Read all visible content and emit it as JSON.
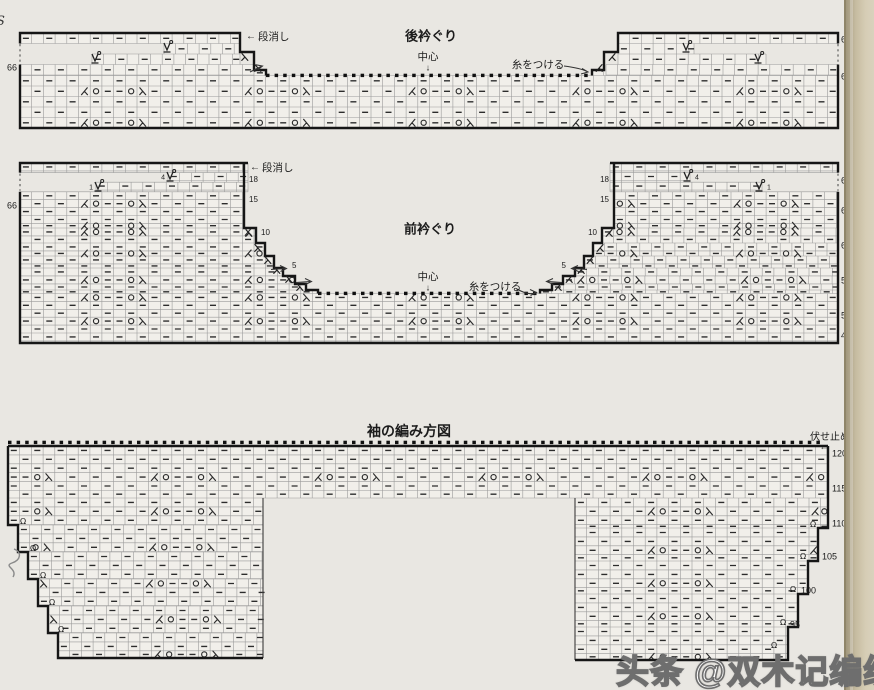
{
  "page": {
    "width": 874,
    "height": 690,
    "background": "#e9e7e2",
    "edge_strip_colors": [
      "#a1977d",
      "#c6bca1",
      "#d9d2bd"
    ]
  },
  "edge_fragment": "S",
  "watermark": {
    "text": "头条 @双木记编织"
  },
  "motif_sequence": [
    "ssk",
    "yo",
    "dash",
    "dash",
    "yo",
    "k2tog"
  ],
  "charts": [
    {
      "id": "back-neckline",
      "grid": {
        "cw": 11.7,
        "ch": 10.5,
        "x0": 20,
        "y0": 33,
        "m0": 5,
        "rm0": 2,
        "rp": 3,
        "rmin": 4
      },
      "bands": [
        [
          20,
          33,
          240,
          43.5
        ],
        [
          164,
          43.5,
          240,
          54
        ],
        [
          92,
          54,
          240,
          64.5
        ],
        [
          20,
          64.5,
          254,
          75.5
        ],
        [
          254,
          70,
          266,
          75.5
        ],
        [
          618,
          33,
          838,
          43.5
        ],
        [
          618,
          43.5,
          694,
          54
        ],
        [
          618,
          54,
          766,
          64.5
        ],
        [
          606,
          64.5,
          838,
          75.5
        ],
        [
          592,
          70,
          606,
          75.5
        ],
        [
          20,
          75.5,
          838,
          128
        ]
      ],
      "outlines": [
        "M20,43.5 V33 H240 V52 H254 V70 H266 V75.5",
        "M838,43.5 V33 H618 V52 H604 V70 H592 V75.5",
        "M20,64.5 V128 H838 V64.5"
      ],
      "thin": [],
      "dotted_v": [
        [
          20,
          44,
          20,
          63
        ],
        [
          838,
          44,
          838,
          63
        ]
      ],
      "dots": [
        [
          266,
          592,
          75.5
        ]
      ],
      "marks": [
        {
          "g": "wrap",
          "x": 167,
          "y": 47
        },
        {
          "g": "wrap",
          "x": 95,
          "y": 58
        },
        {
          "g": "wrap",
          "x": 686,
          "y": 47
        },
        {
          "g": "wrap",
          "x": 758,
          "y": 58
        },
        {
          "g": "k2tog",
          "x": 245,
          "y": 57
        },
        {
          "g": "k2tog",
          "x": 258,
          "y": 68
        },
        {
          "g": "ssk",
          "x": 612,
          "y": 57
        },
        {
          "g": "ssk",
          "x": 599,
          "y": 68
        }
      ],
      "leaders": [
        {
          "d": "M564,66 Q580,68 587,71.5 M582,68.5 L588,72 L581,74"
        },
        {
          "d": "M250,72 L261,66.5 M256,64.8 L262.5,66 L257.5,70"
        }
      ],
      "labels": [
        {
          "n": "chart1-title",
          "t": "後衿ぐり",
          "x": 431,
          "y": 36,
          "fs": 13,
          "b": 1,
          "a": "c"
        },
        {
          "n": "chart1-dankeshi-arrow",
          "t": "←",
          "x": 246,
          "y": 37,
          "fs": 10,
          "a": "l"
        },
        {
          "n": "chart1-dankeshi",
          "t": "段消し",
          "x": 258,
          "y": 37,
          "fs": 10.5,
          "a": "l"
        },
        {
          "n": "chart1-center",
          "t": "中心",
          "x": 428,
          "y": 57,
          "fs": 10.5,
          "a": "c"
        },
        {
          "n": "chart1-center-arrow",
          "t": "↓",
          "x": 428,
          "y": 68,
          "fs": 9,
          "a": "c"
        },
        {
          "n": "chart1-attach-yarn",
          "t": "糸をつける",
          "x": 538,
          "y": 65,
          "fs": 10.5,
          "a": "c"
        },
        {
          "n": "chart1-row-66-left",
          "t": "66",
          "x": 17,
          "y": 68,
          "fs": 9,
          "a": "r"
        },
        {
          "n": "chart1-row-66-right",
          "t": "66",
          "x": 841,
          "y": 40,
          "fs": 9,
          "a": "l"
        },
        {
          "n": "chart1-row-65-right",
          "t": "65",
          "x": 841,
          "y": 77,
          "fs": 9,
          "a": "l"
        }
      ]
    },
    {
      "id": "front-neckline",
      "grid": {
        "cw": 11.7,
        "ch": 7.9,
        "x0": 20,
        "y0": 163,
        "m0": 5,
        "rm0": 2,
        "rp": 3,
        "rmin": 5
      },
      "bands": [
        [
          20,
          163,
          248,
          172.6
        ],
        [
          168,
          172.6,
          248,
          182.2
        ],
        [
          96,
          182.2,
          248,
          191.8
        ],
        [
          20,
          191.8,
          244,
          228
        ],
        [
          20,
          228,
          256,
          243
        ],
        [
          20,
          243,
          265,
          256
        ],
        [
          20,
          256,
          274,
          268
        ],
        [
          20,
          268,
          283,
          276
        ],
        [
          20,
          276,
          295,
          284
        ],
        [
          20,
          284,
          306,
          290
        ],
        [
          20,
          290,
          318,
          293.5
        ],
        [
          610,
          163,
          838,
          172.6
        ],
        [
          610,
          172.6,
          690,
          182.2
        ],
        [
          610,
          182.2,
          762,
          191.8
        ],
        [
          614,
          191.8,
          838,
          228
        ],
        [
          602,
          228,
          838,
          243
        ],
        [
          593,
          243,
          838,
          256
        ],
        [
          584,
          256,
          838,
          268
        ],
        [
          575,
          268,
          838,
          276
        ],
        [
          563,
          276,
          838,
          284
        ],
        [
          552,
          284,
          838,
          290
        ],
        [
          540,
          290,
          838,
          293.5
        ],
        [
          20,
          293.5,
          838,
          343
        ]
      ],
      "outlines": [
        "M20,172.6 V163 H248 M244,163 V228 H256 V243 H265 V256 H274 V268 H283 V276 H295 V284 H306 V290 H318 V293.5",
        "M838,172.6 V163 H610 M614,163 V228 H602 V243 H593 V256 H584 V268 H575 V276 H563 V284 H552 V290 H540 V293.5",
        "M20,191.8 V343 H838 V191.8"
      ],
      "thin": [],
      "dotted_v": [
        [
          20,
          173.6,
          20,
          190.8
        ],
        [
          838,
          173.6,
          838,
          190.8
        ]
      ],
      "dots": [
        [
          318,
          540,
          293.5
        ]
      ],
      "marks": [
        {
          "g": "wrap",
          "x": 170,
          "y": 176
        },
        {
          "g": "wrap",
          "x": 98,
          "y": 186
        },
        {
          "g": "wrap",
          "x": 687,
          "y": 176
        },
        {
          "g": "wrap",
          "x": 759,
          "y": 186
        },
        {
          "g": "k2tog",
          "x": 249,
          "y": 233
        },
        {
          "g": "k2tog",
          "x": 258,
          "y": 248
        },
        {
          "g": "k2tog",
          "x": 268,
          "y": 260
        },
        {
          "g": "k2tog",
          "x": 277,
          "y": 270
        },
        {
          "g": "k2tog",
          "x": 289,
          "y": 279
        },
        {
          "g": "k2tog",
          "x": 300,
          "y": 287
        },
        {
          "g": "ssk",
          "x": 609,
          "y": 233
        },
        {
          "g": "ssk",
          "x": 600,
          "y": 248
        },
        {
          "g": "ssk",
          "x": 590,
          "y": 260
        },
        {
          "g": "ssk",
          "x": 581,
          "y": 270
        },
        {
          "g": "ssk",
          "x": 569,
          "y": 279
        },
        {
          "g": "ssk",
          "x": 558,
          "y": 287
        }
      ],
      "leaders": [
        {
          "d": "M271,269.5 L285,268.5 M280,265.5 L286.5,268.5 L280.5,271.5"
        },
        {
          "d": "M296,282.5 L310,281.5 M305,278.5 L311.5,281.5 L305.5,284.5"
        },
        {
          "d": "M587,269.5 L573,268.5 M578,265.5 L571.5,268.5 L578.5,271.5"
        },
        {
          "d": "M562,282.5 L548,281.5 M553,278.5 L546.5,281.5 L553.5,284.5"
        },
        {
          "d": "M517,289 Q529,296 536,292.5 M530,289.5 L536.5,292.5 L530.5,295.5"
        }
      ],
      "labels": [
        {
          "n": "chart2-title",
          "t": "前衿ぐり",
          "x": 430,
          "y": 229,
          "fs": 13,
          "b": 1,
          "a": "c"
        },
        {
          "n": "chart2-dankeshi-arrow",
          "t": "←",
          "x": 250,
          "y": 168,
          "fs": 10,
          "a": "l"
        },
        {
          "n": "chart2-dankeshi",
          "t": "段消し",
          "x": 262,
          "y": 168,
          "fs": 10.5,
          "a": "l"
        },
        {
          "n": "chart2-center",
          "t": "中心",
          "x": 428,
          "y": 277,
          "fs": 10.5,
          "a": "c"
        },
        {
          "n": "chart2-center-arrow",
          "t": "↓",
          "x": 428,
          "y": 288,
          "fs": 9,
          "a": "c"
        },
        {
          "n": "chart2-attach-yarn",
          "t": "糸をつける",
          "x": 495,
          "y": 287,
          "fs": 10.5,
          "a": "c"
        },
        {
          "n": "chart2-row-66-left",
          "t": "66",
          "x": 17,
          "y": 206,
          "fs": 9,
          "a": "r"
        },
        {
          "n": "chart2-wrap4-left",
          "t": "4",
          "x": 165,
          "y": 178,
          "fs": 7,
          "a": "r"
        },
        {
          "n": "chart2-wrap1-left",
          "t": "1",
          "x": 93,
          "y": 188,
          "fs": 7,
          "a": "r"
        },
        {
          "n": "chart2-wrap4-right",
          "t": "4",
          "x": 695,
          "y": 178,
          "fs": 7,
          "a": "l"
        },
        {
          "n": "chart2-wrap1-right",
          "t": "1",
          "x": 767,
          "y": 188,
          "fs": 7,
          "a": "l"
        },
        {
          "n": "chart2-step18-left",
          "t": "18",
          "x": 249,
          "y": 180,
          "fs": 8,
          "a": "l"
        },
        {
          "n": "chart2-step15-left",
          "t": "15",
          "x": 249,
          "y": 200,
          "fs": 8,
          "a": "l"
        },
        {
          "n": "chart2-step10-left",
          "t": "10",
          "x": 261,
          "y": 233,
          "fs": 8,
          "a": "l"
        },
        {
          "n": "chart2-step5-left",
          "t": "5",
          "x": 292,
          "y": 266,
          "fs": 8,
          "a": "l"
        },
        {
          "n": "chart2-step18-right",
          "t": "18",
          "x": 609,
          "y": 180,
          "fs": 8,
          "a": "r"
        },
        {
          "n": "chart2-step15-right",
          "t": "15",
          "x": 609,
          "y": 200,
          "fs": 8,
          "a": "r"
        },
        {
          "n": "chart2-step10-right",
          "t": "10",
          "x": 597,
          "y": 233,
          "fs": 8,
          "a": "r"
        },
        {
          "n": "chart2-step5-right",
          "t": "5",
          "x": 566,
          "y": 266,
          "fs": 8,
          "a": "r"
        },
        {
          "n": "chart2-row-66-right",
          "t": "66",
          "x": 841,
          "y": 181,
          "fs": 9,
          "a": "l"
        },
        {
          "n": "chart2-row-65-right",
          "t": "65",
          "x": 841,
          "y": 211,
          "fs": 9,
          "a": "l"
        },
        {
          "n": "chart2-row-60-right",
          "t": "60",
          "x": 841,
          "y": 246,
          "fs": 9,
          "a": "l"
        },
        {
          "n": "chart2-row-55-right",
          "t": "55",
          "x": 841,
          "y": 281,
          "fs": 9,
          "a": "l"
        },
        {
          "n": "chart2-row-50-right",
          "t": "50",
          "x": 841,
          "y": 316,
          "fs": 9,
          "a": "l"
        },
        {
          "n": "chart2-row-47-right",
          "t": "47",
          "x": 841,
          "y": 336,
          "fs": 9,
          "a": "l"
        }
      ]
    },
    {
      "id": "sleeve",
      "grid": {
        "cw": 11.7,
        "ch": 8.9,
        "x0": 8,
        "y0": 446,
        "m0": 12,
        "rm0": 3,
        "rp": 4,
        "rmin": 0
      },
      "bands": [
        [
          8,
          446,
          828,
          498
        ],
        [
          8,
          498,
          263,
          525
        ],
        [
          18,
          525,
          263,
          552
        ],
        [
          28,
          552,
          263,
          579
        ],
        [
          38,
          579,
          263,
          606
        ],
        [
          48,
          606,
          263,
          633
        ],
        [
          58,
          633,
          263,
          658
        ],
        [
          575,
          498,
          828,
          528
        ],
        [
          575,
          528,
          818,
          561
        ],
        [
          575,
          561,
          808,
          594
        ],
        [
          575,
          594,
          798,
          627
        ],
        [
          575,
          627,
          788,
          660
        ]
      ],
      "outlines": [
        "M8,446 H828",
        "M8,446 V525 H18 V552 H28 V579 H38 V606 H48 V633 H58 V658 H263",
        "M828,446 V528 H818 V561 H808 V594 H798 V627 H788 V660 H575"
      ],
      "thin": [
        "M263,498 V658",
        "M575,498 V660"
      ],
      "dotted_v": [],
      "dots": [
        [
          8,
          828,
          442.5
        ]
      ],
      "marks": [
        {
          "g": "tw",
          "x": 23,
          "y": 521
        },
        {
          "g": "tw",
          "x": 33,
          "y": 548
        },
        {
          "g": "tw",
          "x": 43,
          "y": 575
        },
        {
          "g": "tw",
          "x": 52,
          "y": 602
        },
        {
          "g": "tw",
          "x": 61,
          "y": 629
        },
        {
          "g": "tw",
          "x": 813,
          "y": 524
        },
        {
          "g": "tw",
          "x": 803,
          "y": 556
        },
        {
          "g": "tw",
          "x": 793,
          "y": 589
        },
        {
          "g": "tw",
          "x": 783,
          "y": 622
        },
        {
          "g": "tw",
          "x": 774,
          "y": 645
        }
      ],
      "leaders": [
        {
          "d": "M14,549 C22,552 21,560 12,563 C3,566 18,569 13,577",
          "pencil": 1
        }
      ],
      "labels": [
        {
          "n": "chart3-title",
          "t": "袖の編み方図",
          "x": 409,
          "y": 431,
          "fs": 14,
          "b": 1,
          "a": "c"
        },
        {
          "n": "chart3-bindoff",
          "t": "伏せ止め",
          "x": 830,
          "y": 438,
          "fs": 10,
          "a": "c"
        },
        {
          "n": "chart3-bindoff-arrow",
          "t": "←",
          "x": 824,
          "y": 447,
          "fs": 9,
          "a": "c"
        },
        {
          "n": "chart3-row-120",
          "t": "120",
          "x": 832,
          "y": 454,
          "fs": 9,
          "a": "l"
        },
        {
          "n": "chart3-row-115",
          "t": "115",
          "x": 832,
          "y": 489,
          "fs": 9,
          "a": "l"
        },
        {
          "n": "chart3-row-110",
          "t": "110",
          "x": 832,
          "y": 524,
          "fs": 9,
          "a": "l"
        },
        {
          "n": "chart3-row-105",
          "t": "105",
          "x": 822,
          "y": 557,
          "fs": 9,
          "a": "l"
        },
        {
          "n": "chart3-row-100",
          "t": "100",
          "x": 801,
          "y": 591,
          "fs": 9,
          "a": "l"
        },
        {
          "n": "chart3-row-95",
          "t": "95",
          "x": 790,
          "y": 625,
          "fs": 9,
          "a": "l"
        }
      ]
    }
  ]
}
